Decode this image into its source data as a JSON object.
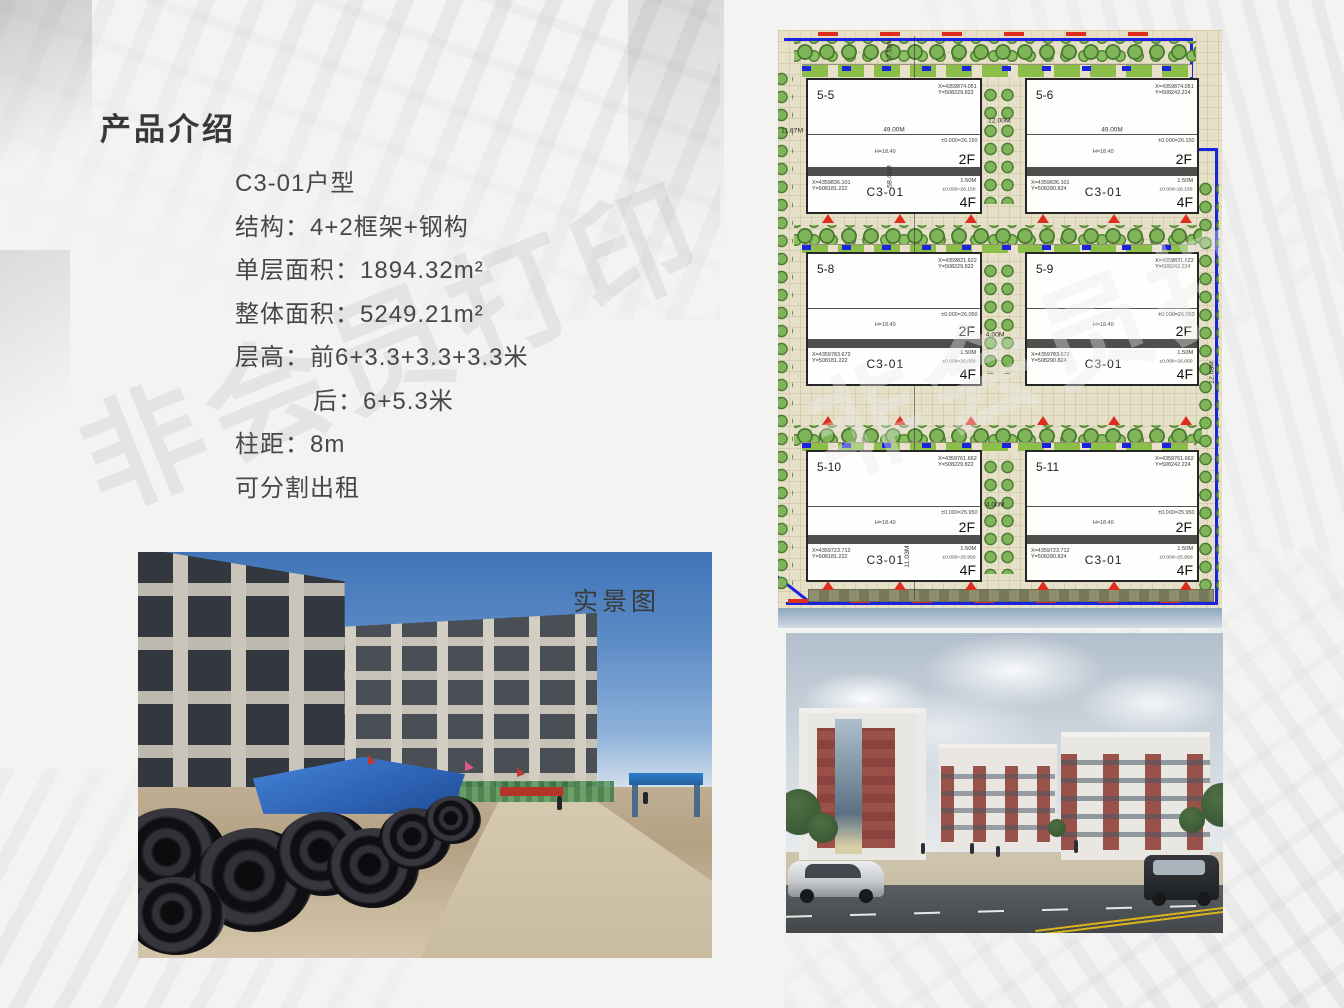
{
  "title": "产品介绍",
  "watermark": {
    "text": "非会员打印"
  },
  "specs": {
    "lines": [
      "C3-01户型",
      "结构：4+2框架+钢构",
      "单层面积：1894.32m²",
      "整体面积：5249.21m²",
      "层高：前6+3.3+3.3+3.3米",
      "后：6+5.3米",
      "柱距：8m",
      "可分割出租"
    ]
  },
  "photo": {
    "label": "实景图"
  },
  "site_plan": {
    "colors": {
      "boundary_blue": "#1a23dd",
      "marker_red": "#dd2d1f",
      "tree_green": "#7fb558",
      "paper_beige": "#e7e0c8"
    },
    "dims": {
      "left_setback": "11.87M",
      "top_height": "17.59M",
      "block_span": "58.41M",
      "top_gap": "12.00M",
      "walkway_mid": "4.00M",
      "walkway_low": "4.00M",
      "bottom_setback": "11.03M",
      "right_gap": "12.03M"
    },
    "plots": [
      {
        "id": "5-5",
        "unit": "C3-01",
        "floors_top": "2F",
        "floors_bottom": "4F",
        "width": "49.00M",
        "side": "1.50M",
        "height_note": "H=18.40",
        "level_top": "±0.000=26.150",
        "level_bottom": "±0.000=26.150",
        "coord_ne": "X=4359874.051\nY=508229.822",
        "coord_sw": "X=4359836.101\nY=508181.222"
      },
      {
        "id": "5-6",
        "unit": "C3-01",
        "floors_top": "2F",
        "floors_bottom": "4F",
        "width": "49.00M",
        "side": "1.50M",
        "height_note": "H=18.40",
        "level_top": "±0.000=26.150",
        "level_bottom": "±0.000=26.150",
        "coord_ne": "X=4359874.051\nY=508242.224",
        "coord_sw": "X=4359836.101\nY=508290.824"
      },
      {
        "id": "5-8",
        "unit": "C3-01",
        "floors_top": "2F",
        "floors_bottom": "4F",
        "side": "1.50M",
        "height_note": "H=18.40",
        "level_top": "±0.000=26.050",
        "level_bottom": "±0.000=26.050",
        "coord_ne": "X=4359821.622\nY=508229.822",
        "coord_sw": "X=4359783.672\nY=508181.222"
      },
      {
        "id": "5-9",
        "unit": "C3-01",
        "floors_top": "2F",
        "floors_bottom": "4F",
        "side": "1.50M",
        "height_note": "H=18.40",
        "level_top": "±0.000=26.050",
        "level_bottom": "±0.000=26.050",
        "coord_ne": "X=4359821.622\nY=508242.224",
        "coord_sw": "X=4359783.672\nY=508290.824"
      },
      {
        "id": "5-10",
        "unit": "C3-01",
        "floors_top": "2F",
        "floors_bottom": "4F",
        "side": "1.50M",
        "height_note": "H=18.40",
        "level_top": "±0.000=25.950",
        "level_bottom": "±0.000=25.950",
        "coord_ne": "X=4359761.662\nY=508229.822",
        "coord_sw": "X=4359723.712\nY=508181.222"
      },
      {
        "id": "5-11",
        "unit": "C3-01",
        "floors_top": "2F",
        "floors_bottom": "4F",
        "side": "1.50M",
        "height_note": "H=18.40",
        "level_top": "±0.000=25.950",
        "level_bottom": "±0.000=25.950",
        "coord_ne": "X=4359761.662\nY=508242.224",
        "coord_sw": "X=4359723.712\nY=508290.824"
      }
    ]
  }
}
